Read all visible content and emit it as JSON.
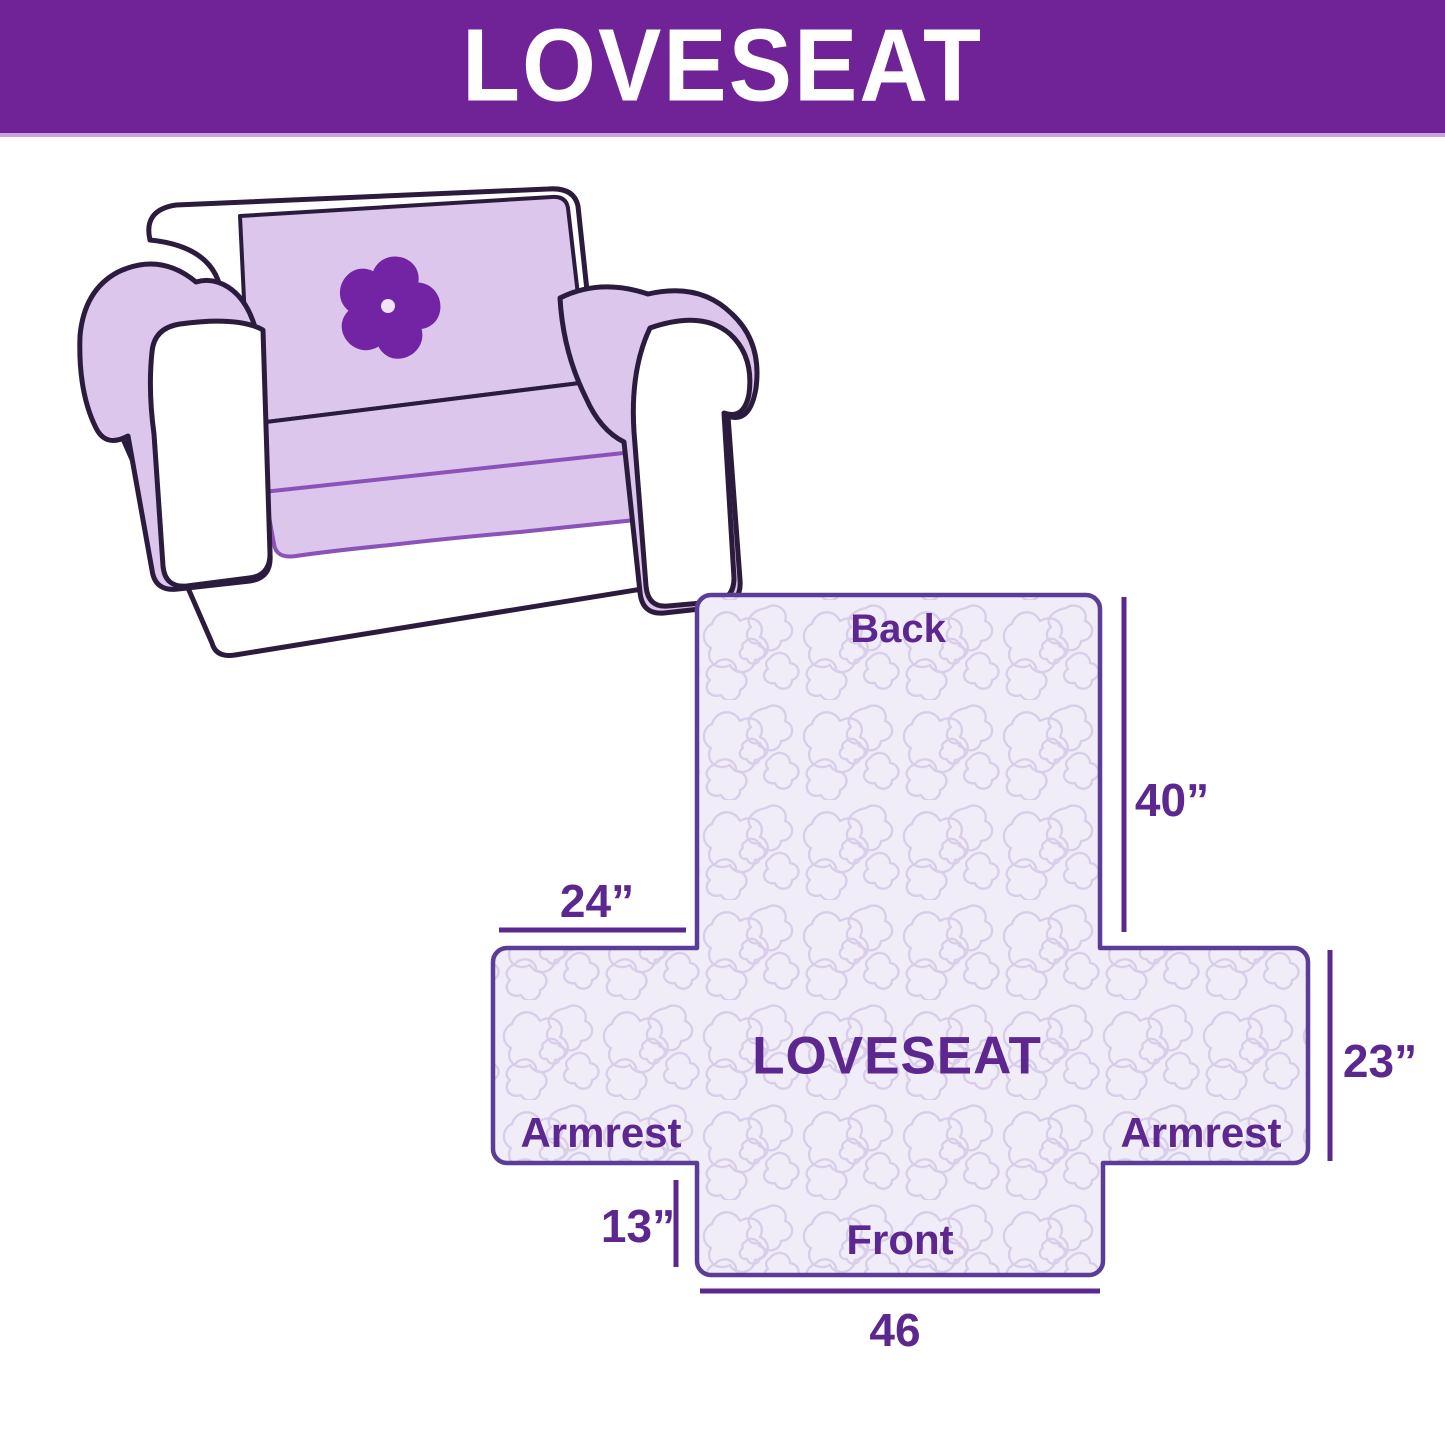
{
  "header": {
    "title": "LOVESEAT"
  },
  "illustration": {
    "description": "loveseat sofa with lavender protective cover",
    "logo": "pinwheel-flower",
    "cover_color": "#DDC6EC",
    "outline_color": "#2B1C3E",
    "logo_color": "#7224A4"
  },
  "diagram": {
    "center_label": "LOVESEAT",
    "back_label": "Back",
    "front_label": "Front",
    "armrest_left_label": "Armrest",
    "armrest_right_label": "Armrest",
    "dim_back_height": "40”",
    "dim_armrest_width": "24”",
    "dim_side_height": "23”",
    "dim_front_drop": "13”",
    "dim_front_width": "46",
    "colors": {
      "outline": "#5A3D96",
      "fill": "#F1EDF8",
      "quilt_pattern": "#D9CEE9",
      "text": "#5D2790",
      "header_bg": "#6F2396"
    }
  }
}
